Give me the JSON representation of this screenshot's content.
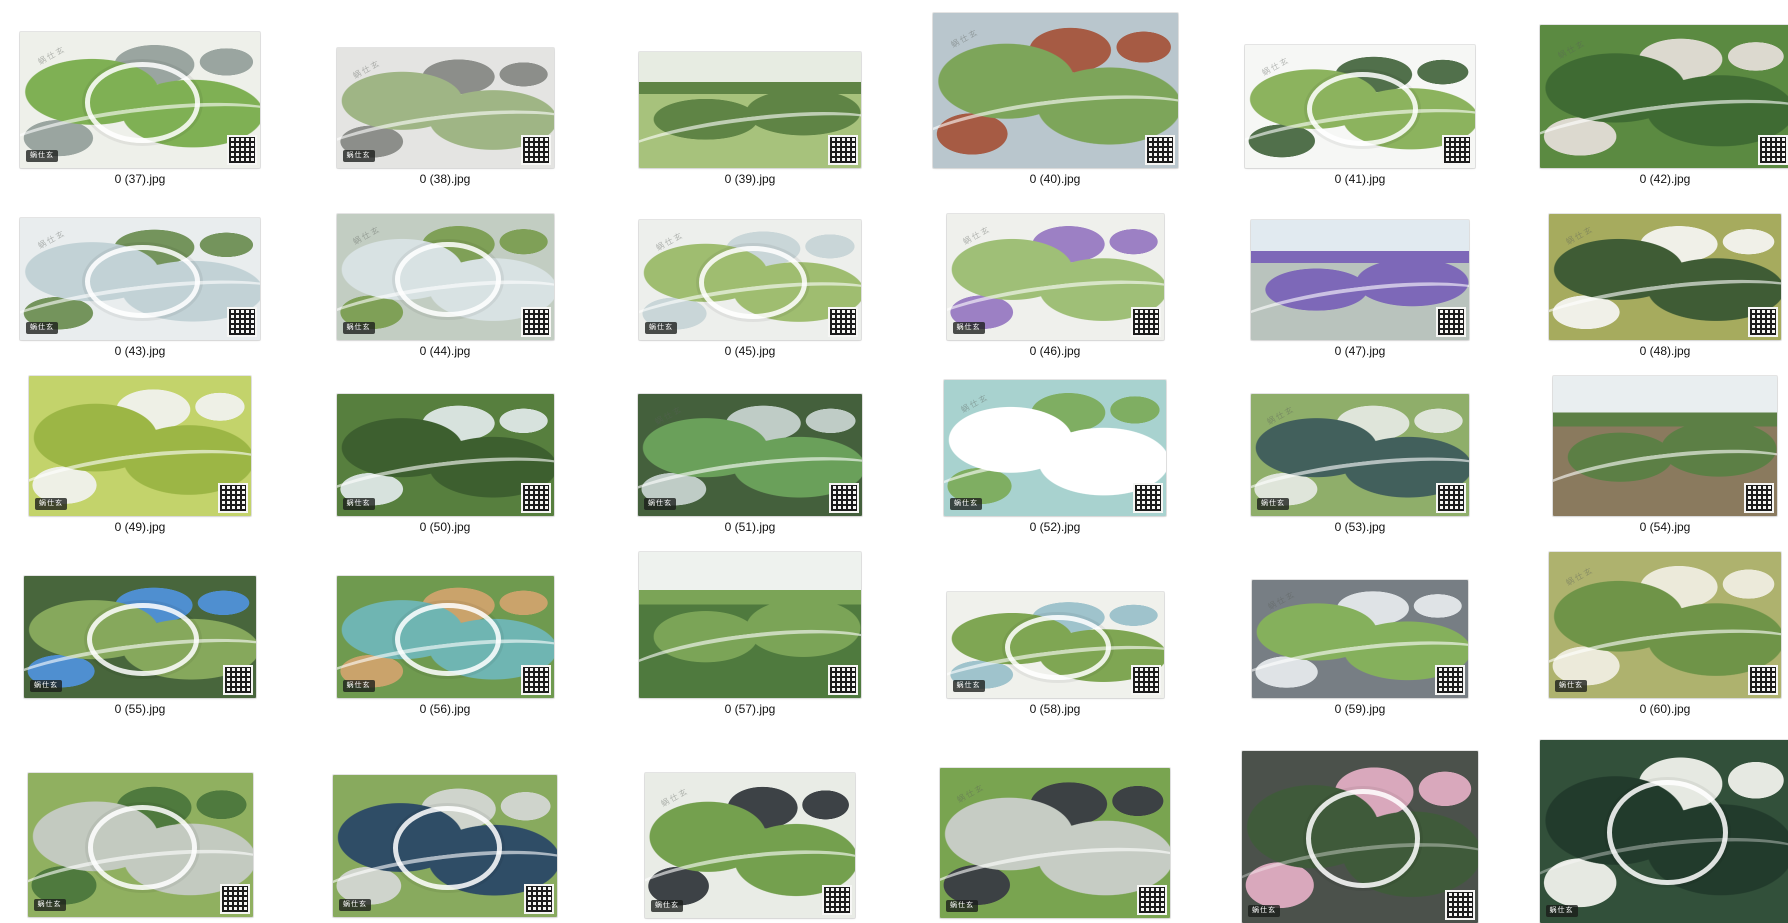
{
  "window": {
    "background": "#ffffff",
    "view": "thumbnail-grid"
  },
  "watermark": {
    "badge": "蜗仕玄",
    "diagonal": "蜗仕玄"
  },
  "grid": {
    "columns_x": [
      140,
      445,
      750,
      1055,
      1360,
      1665
    ],
    "rows": [
      {
        "bottom": 168,
        "label_y": 172
      },
      {
        "bottom": 340,
        "label_y": 344
      },
      {
        "bottom": 516,
        "label_y": 520
      },
      {
        "bottom": 698,
        "label_y": 702
      },
      {
        "bottom": null,
        "label_y": null,
        "clipped": true
      }
    ]
  },
  "files": [
    {
      "label": "0 (37).jpg",
      "col": 0,
      "row": 0,
      "w": 240,
      "h": 136,
      "kind": "aerial",
      "ring": true,
      "c1": "#eef0ea",
      "c2": "#7fb054",
      "c3": "#9aa5a0",
      "qr": true,
      "badge": true,
      "wm": true
    },
    {
      "label": "0 (38).jpg",
      "col": 1,
      "row": 0,
      "w": 217,
      "h": 120,
      "kind": "aerial",
      "ring": false,
      "c1": "#e4e4e2",
      "c2": "#9fb585",
      "c3": "#8c8e8a",
      "qr": true,
      "badge": true,
      "wm": true
    },
    {
      "label": "0 (39).jpg",
      "col": 2,
      "row": 0,
      "w": 222,
      "h": 116,
      "kind": "photo",
      "ring": false,
      "c1": "#a7c27c",
      "c2": "#5f8445",
      "c3": "#e7ece2",
      "qr": true,
      "badge": false,
      "wm": false
    },
    {
      "label": "0 (40).jpg",
      "col": 3,
      "row": 0,
      "w": 245,
      "h": 155,
      "kind": "aerial",
      "ring": false,
      "c1": "#b9c6cd",
      "c2": "#7da55a",
      "c3": "#a65b44",
      "qr": true,
      "badge": false,
      "wm": true
    },
    {
      "label": "0 (41).jpg",
      "col": 4,
      "row": 0,
      "w": 230,
      "h": 123,
      "kind": "aerial",
      "ring": true,
      "c1": "#f6f7f5",
      "c2": "#8cb35e",
      "c3": "#51704b",
      "qr": true,
      "badge": false,
      "wm": true
    },
    {
      "label": "0 (42).jpg",
      "col": 5,
      "row": 0,
      "w": 251,
      "h": 143,
      "kind": "aerial",
      "ring": false,
      "c1": "#5b8a41",
      "c2": "#3f6b33",
      "c3": "#dcd9cf",
      "qr": true,
      "badge": false,
      "wm": true
    },
    {
      "label": "0 (43).jpg",
      "col": 0,
      "row": 1,
      "w": 240,
      "h": 122,
      "kind": "aerial",
      "ring": true,
      "c1": "#e9edee",
      "c2": "#c2d2d6",
      "c3": "#74945c",
      "qr": true,
      "badge": true,
      "wm": true
    },
    {
      "label": "0 (44).jpg",
      "col": 1,
      "row": 1,
      "w": 217,
      "h": 126,
      "kind": "aerial",
      "ring": true,
      "c1": "#c2cdc2",
      "c2": "#d8e2e3",
      "c3": "#7fa057",
      "qr": true,
      "badge": true,
      "wm": true
    },
    {
      "label": "0 (45).jpg",
      "col": 2,
      "row": 1,
      "w": 222,
      "h": 120,
      "kind": "aerial",
      "ring": true,
      "c1": "#edefec",
      "c2": "#9fbd70",
      "c3": "#c9d6d8",
      "qr": true,
      "badge": true,
      "wm": true
    },
    {
      "label": "0 (46).jpg",
      "col": 3,
      "row": 1,
      "w": 217,
      "h": 126,
      "kind": "aerial",
      "ring": false,
      "c1": "#eff0ec",
      "c2": "#9fbf77",
      "c3": "#9c80c4",
      "qr": true,
      "badge": true,
      "wm": true
    },
    {
      "label": "0 (47).jpg",
      "col": 4,
      "row": 1,
      "w": 218,
      "h": 120,
      "kind": "photo",
      "ring": false,
      "c1": "#b9c3bd",
      "c2": "#7d68b8",
      "c3": "#e1eaf0",
      "qr": true,
      "badge": false,
      "wm": false
    },
    {
      "label": "0 (48).jpg",
      "col": 5,
      "row": 1,
      "w": 232,
      "h": 126,
      "kind": "aerial",
      "ring": false,
      "c1": "#a6ab5e",
      "c2": "#3f5c35",
      "c3": "#f0f0e8",
      "qr": true,
      "badge": false,
      "wm": true
    },
    {
      "label": "0 (49).jpg",
      "col": 0,
      "row": 2,
      "w": 222,
      "h": 140,
      "kind": "aerial",
      "ring": false,
      "c1": "#c3d36b",
      "c2": "#9cb645",
      "c3": "#eef0e6",
      "qr": true,
      "badge": true,
      "wm": false
    },
    {
      "label": "0 (50).jpg",
      "col": 1,
      "row": 2,
      "w": 217,
      "h": 122,
      "kind": "aerial",
      "ring": false,
      "c1": "#577f3e",
      "c2": "#3d5f2f",
      "c3": "#d7e2dd",
      "qr": true,
      "badge": true,
      "wm": false
    },
    {
      "label": "0 (51).jpg",
      "col": 2,
      "row": 2,
      "w": 224,
      "h": 122,
      "kind": "aerial",
      "ring": false,
      "c1": "#44603c",
      "c2": "#6aa05a",
      "c3": "#bfccc6",
      "qr": true,
      "badge": true,
      "wm": true
    },
    {
      "label": "0 (52).jpg",
      "col": 3,
      "row": 2,
      "w": 222,
      "h": 136,
      "kind": "aerial",
      "ring": false,
      "c1": "#a8d2cf",
      "c2": "#ffffff",
      "c3": "#7fae62",
      "qr": true,
      "badge": true,
      "wm": true
    },
    {
      "label": "0 (53).jpg",
      "col": 4,
      "row": 2,
      "w": 218,
      "h": 122,
      "kind": "aerial",
      "ring": false,
      "c1": "#8fae6a",
      "c2": "#42605c",
      "c3": "#dfe5da",
      "qr": true,
      "badge": true,
      "wm": true
    },
    {
      "label": "0 (54).jpg",
      "col": 5,
      "row": 2,
      "w": 224,
      "h": 140,
      "kind": "photo",
      "ring": false,
      "c1": "#8a7a5e",
      "c2": "#5c7f45",
      "c3": "#e9eef0",
      "qr": true,
      "badge": false,
      "wm": false
    },
    {
      "label": "0 (55).jpg",
      "col": 0,
      "row": 3,
      "w": 232,
      "h": 122,
      "kind": "aerial",
      "ring": true,
      "c1": "#48663c",
      "c2": "#86a85c",
      "c3": "#4f8fd0",
      "qr": true,
      "badge": true,
      "wm": false
    },
    {
      "label": "0 (56).jpg",
      "col": 1,
      "row": 3,
      "w": 217,
      "h": 122,
      "kind": "aerial",
      "ring": true,
      "c1": "#6f9a4f",
      "c2": "#6fb5b2",
      "c3": "#caa36b",
      "qr": true,
      "badge": true,
      "wm": false
    },
    {
      "label": "0 (57).jpg",
      "col": 2,
      "row": 3,
      "w": 222,
      "h": 146,
      "kind": "photo",
      "ring": false,
      "c1": "#4f7a3e",
      "c2": "#7ba457",
      "c3": "#eef2ee",
      "qr": true,
      "badge": false,
      "wm": false
    },
    {
      "label": "0 (58).jpg",
      "col": 3,
      "row": 3,
      "w": 217,
      "h": 106,
      "kind": "aerial",
      "ring": true,
      "c1": "#f0f1ec",
      "c2": "#7fa653",
      "c3": "#9fc3cc",
      "qr": true,
      "badge": true,
      "wm": false
    },
    {
      "label": "0 (59).jpg",
      "col": 4,
      "row": 3,
      "w": 216,
      "h": 118,
      "kind": "aerial",
      "ring": false,
      "c1": "#777e84",
      "c2": "#85b05c",
      "c3": "#dfe3e6",
      "qr": true,
      "badge": false,
      "wm": true
    },
    {
      "label": "0 (60).jpg",
      "col": 5,
      "row": 3,
      "w": 232,
      "h": 146,
      "kind": "aerial",
      "ring": false,
      "c1": "#aeb26e",
      "c2": "#6f9448",
      "c3": "#eceada",
      "qr": true,
      "badge": true,
      "wm": true
    },
    {
      "label": null,
      "col": 0,
      "row": 4,
      "top": 773,
      "w": 225,
      "h": 144,
      "kind": "aerial",
      "ring": true,
      "c1": "#90b060",
      "c2": "#c3cac0",
      "c3": "#4f7a3e",
      "qr": true,
      "badge": true,
      "wm": false
    },
    {
      "label": null,
      "col": 1,
      "row": 4,
      "top": 775,
      "w": 224,
      "h": 142,
      "kind": "aerial",
      "ring": true,
      "c1": "#88aa5e",
      "c2": "#2f4d66",
      "c3": "#cfd4cc",
      "qr": true,
      "badge": true,
      "wm": false
    },
    {
      "label": null,
      "col": 2,
      "row": 4,
      "top": 773,
      "w": 210,
      "h": 145,
      "kind": "aerial",
      "ring": false,
      "c1": "#e9ece6",
      "c2": "#74a04e",
      "c3": "#3d4246",
      "qr": true,
      "badge": true,
      "wm": true
    },
    {
      "label": null,
      "col": 3,
      "row": 4,
      "top": 768,
      "w": 230,
      "h": 150,
      "kind": "aerial",
      "ring": false,
      "c1": "#79a450",
      "c2": "#c6ccc4",
      "c3": "#3c4144",
      "qr": true,
      "badge": true,
      "wm": true
    },
    {
      "label": null,
      "col": 4,
      "row": 4,
      "top": 751,
      "w": 236,
      "h": 172,
      "kind": "dark",
      "ring": true,
      "c1": "#4b514b",
      "c2": "#3f5a3a",
      "c3": "#d9a8bc",
      "qr": true,
      "badge": true,
      "wm": false
    },
    {
      "label": null,
      "col": 5,
      "row": 4,
      "top": 740,
      "w": 251,
      "h": 183,
      "kind": "dark",
      "ring": true,
      "c1": "#32503a",
      "c2": "#223b2c",
      "c3": "#e6e9e2",
      "qr": false,
      "badge": true,
      "wm": false
    }
  ]
}
